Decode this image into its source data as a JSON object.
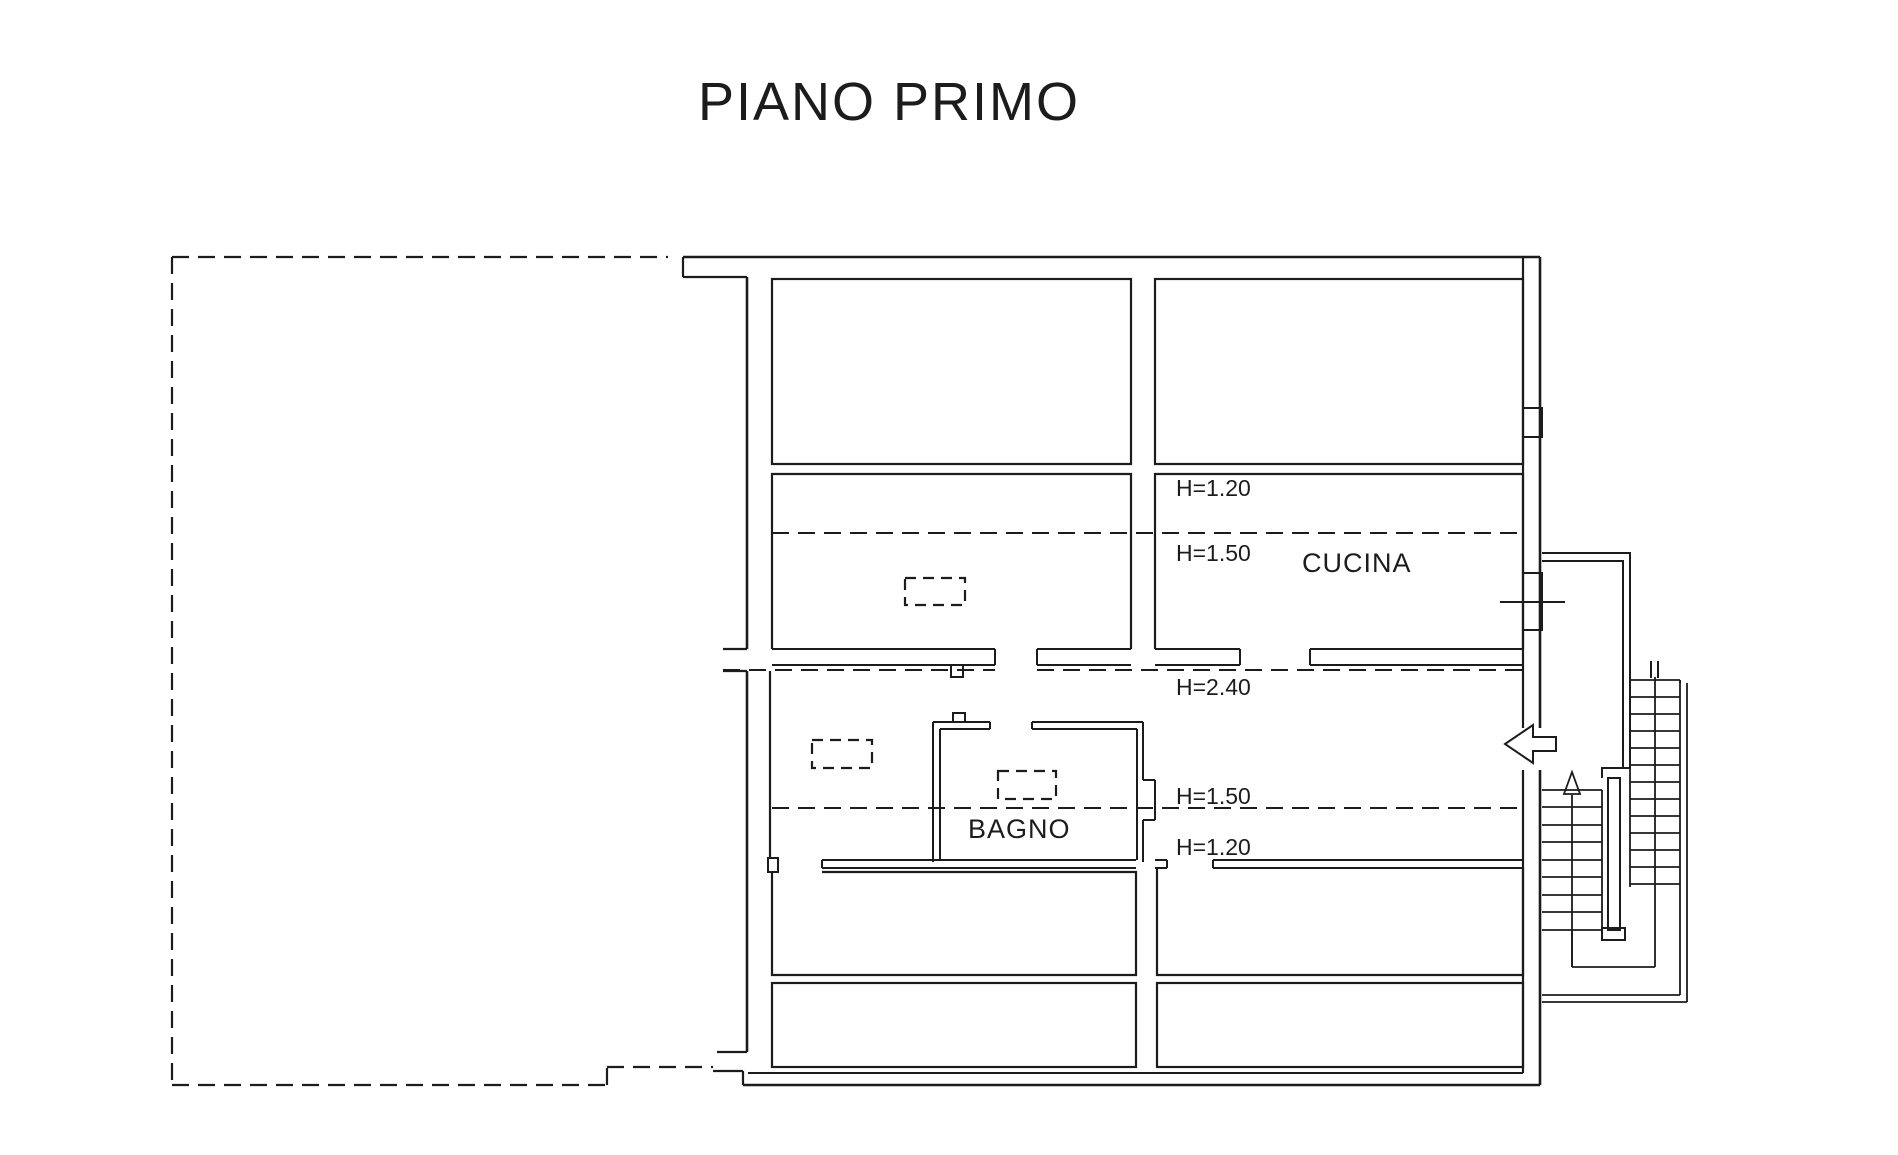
{
  "page": {
    "background": "#ffffff",
    "line_color": "#1c1c1c"
  },
  "title": "PIANO PRIMO",
  "rooms": {
    "kitchen_label": "CUCINA",
    "bathroom_label": "BAGNO"
  },
  "annotations": {
    "upper_h120": "H=1.20",
    "upper_h150": "H=1.50",
    "corridor_h240": "H=2.40",
    "lower_h150": "H=1.50",
    "lower_h120": "H=1.20"
  }
}
